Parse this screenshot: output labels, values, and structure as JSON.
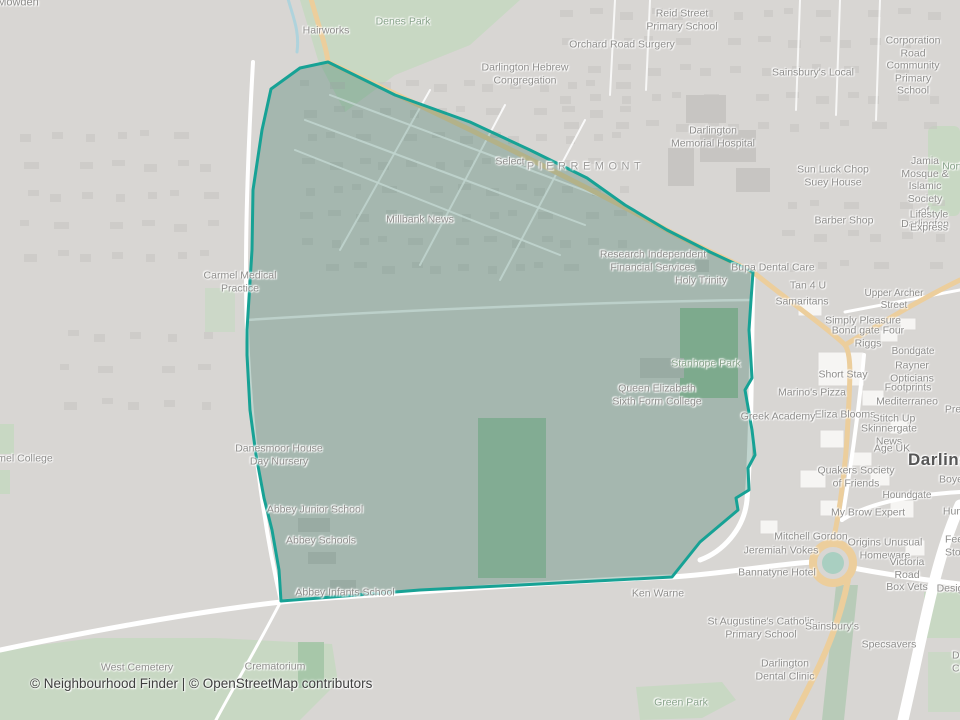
{
  "attribution": "© Neighbourhood Finder | © OpenStreetMap contributors",
  "colors": {
    "base": "#d8d6d3",
    "road_white": "#ffffff",
    "road_primary": "#ecce9c",
    "green_area": "#c8d8c3",
    "green_area_dark": "#9fc3a3",
    "water": "#abd3dd",
    "building": "#c7c5c2",
    "building_white": "#f6f5f3",
    "boundary": "#17a295",
    "boundary_fill": "rgba(47,112,92,0.30)",
    "label_gray": "#8e8d8b",
    "label_green": "#87a289",
    "label_dark": "#565656",
    "attribution_text": "#3f3f3f"
  },
  "map_labels": [
    {
      "text": "Mowden",
      "x": 18,
      "y": 3,
      "type": "place"
    },
    {
      "text": "Hairworks",
      "x": 326,
      "y": 31,
      "type": "poi"
    },
    {
      "text": "Denes Park",
      "x": 403,
      "y": 22,
      "type": "park"
    },
    {
      "text": "Reid Street\nPrimary School",
      "x": 682,
      "y": 20,
      "type": "poi"
    },
    {
      "text": "Orchard Road Surgery",
      "x": 622,
      "y": 45,
      "type": "poi"
    },
    {
      "text": "Darlington Hebrew\nCongregation",
      "x": 525,
      "y": 74,
      "type": "poi"
    },
    {
      "text": "Sainsbury's Local",
      "x": 813,
      "y": 73,
      "type": "poi"
    },
    {
      "text": "Corporation\nRoad Community\nPrimary School",
      "x": 913,
      "y": 66,
      "type": "poi"
    },
    {
      "text": "Darlington\nMemorial Hospital",
      "x": 713,
      "y": 137,
      "type": "poi"
    },
    {
      "text": "Select",
      "x": 510,
      "y": 162,
      "type": "poi"
    },
    {
      "text": "PIERREMONT",
      "x": 586,
      "y": 167,
      "type": "district"
    },
    {
      "text": "Sun Luck Chop\nSuey House",
      "x": 833,
      "y": 176,
      "type": "poi"
    },
    {
      "text": "Nort",
      "x": 952,
      "y": 167,
      "type": "park"
    },
    {
      "text": "Jamia Mosque &\nIslamic Society\nof Darlington",
      "x": 925,
      "y": 193,
      "type": "poi"
    },
    {
      "text": "Millbank News",
      "x": 420,
      "y": 220,
      "type": "poi"
    },
    {
      "text": "Barber Shop",
      "x": 844,
      "y": 221,
      "type": "poi"
    },
    {
      "text": "Lifestyle Express",
      "x": 929,
      "y": 221,
      "type": "poi"
    },
    {
      "text": "Research Independent\nFinancial Services",
      "x": 653,
      "y": 261,
      "type": "poi"
    },
    {
      "text": "Bupa Dental Care",
      "x": 773,
      "y": 268,
      "type": "poi"
    },
    {
      "text": "Holy Trinity",
      "x": 701,
      "y": 281,
      "type": "poi"
    },
    {
      "text": "Carmel Medical\nPractice",
      "x": 240,
      "y": 282,
      "type": "poi"
    },
    {
      "text": "Tan 4 U",
      "x": 808,
      "y": 286,
      "type": "poi"
    },
    {
      "text": "Samaritans",
      "x": 802,
      "y": 302,
      "type": "poi"
    },
    {
      "text": "Upper Archer Street",
      "x": 894,
      "y": 300,
      "type": "street"
    },
    {
      "text": "Simply Pleasure",
      "x": 863,
      "y": 321,
      "type": "poi"
    },
    {
      "text": "Bond gate Four Riggs",
      "x": 868,
      "y": 337,
      "type": "poi"
    },
    {
      "text": "Bondgate",
      "x": 913,
      "y": 352,
      "type": "street"
    },
    {
      "text": "Stanhope Park",
      "x": 706,
      "y": 364,
      "type": "park"
    },
    {
      "text": "Short Stay",
      "x": 843,
      "y": 375,
      "type": "poi"
    },
    {
      "text": "Rayner Opticians",
      "x": 912,
      "y": 372,
      "type": "poi"
    },
    {
      "text": "Footprints",
      "x": 908,
      "y": 388,
      "type": "poi"
    },
    {
      "text": "Marino's Pizza",
      "x": 812,
      "y": 393,
      "type": "poi"
    },
    {
      "text": "Queen Elizabeth\nSixth Form College",
      "x": 657,
      "y": 395,
      "type": "poi"
    },
    {
      "text": "Mediterraneo",
      "x": 907,
      "y": 402,
      "type": "poi"
    },
    {
      "text": "Pre",
      "x": 953,
      "y": 410,
      "type": "poi"
    },
    {
      "text": "Eliza Blooms",
      "x": 845,
      "y": 415,
      "type": "poi"
    },
    {
      "text": "Greek Academy",
      "x": 778,
      "y": 417,
      "type": "poi"
    },
    {
      "text": "Stitch Up",
      "x": 894,
      "y": 419,
      "type": "poi"
    },
    {
      "text": "Skinnergate News",
      "x": 889,
      "y": 435,
      "type": "poi"
    },
    {
      "text": "Age UK",
      "x": 892,
      "y": 449,
      "type": "poi"
    },
    {
      "text": "Danesmoor House\nDay Nursery",
      "x": 279,
      "y": 455,
      "type": "poi"
    },
    {
      "text": "mel College",
      "x": 25,
      "y": 459,
      "type": "poi"
    },
    {
      "text": "Darlington",
      "x": 908,
      "y": 460,
      "type": "town",
      "anchor": "left"
    },
    {
      "text": "Quakers Society\nof Friends",
      "x": 856,
      "y": 477,
      "type": "poi"
    },
    {
      "text": "Boye",
      "x": 951,
      "y": 480,
      "type": "poi"
    },
    {
      "text": "Houndgate",
      "x": 907,
      "y": 496,
      "type": "street"
    },
    {
      "text": "Abbey Junior School",
      "x": 315,
      "y": 510,
      "type": "poi"
    },
    {
      "text": "My Brow Expert",
      "x": 868,
      "y": 513,
      "type": "poi"
    },
    {
      "text": "Hum",
      "x": 954,
      "y": 512,
      "type": "poi"
    },
    {
      "text": "Mitchell Gordon",
      "x": 811,
      "y": 537,
      "type": "poi"
    },
    {
      "text": "Abbey Schools",
      "x": 321,
      "y": 541,
      "type": "poi"
    },
    {
      "text": "Origins Unusual\nHomeware",
      "x": 885,
      "y": 549,
      "type": "poi"
    },
    {
      "text": "Feetha\nStorey",
      "x": 945,
      "y": 546,
      "type": "poi",
      "anchor": "left"
    },
    {
      "text": "Jeremiah Vokes",
      "x": 781,
      "y": 551,
      "type": "poi"
    },
    {
      "text": "Bannatyne Hotel",
      "x": 777,
      "y": 573,
      "type": "poi"
    },
    {
      "text": "Victoria Road\nBox Vets",
      "x": 907,
      "y": 575,
      "type": "poi"
    },
    {
      "text": "Desig",
      "x": 950,
      "y": 589,
      "type": "poi"
    },
    {
      "text": "Abbey Infants School",
      "x": 345,
      "y": 593,
      "type": "poi"
    },
    {
      "text": "Ken Warne",
      "x": 658,
      "y": 594,
      "type": "poi"
    },
    {
      "text": "St Augustine's Catholic\nPrimary School",
      "x": 761,
      "y": 628,
      "type": "poi"
    },
    {
      "text": "Sainsbury's",
      "x": 832,
      "y": 627,
      "type": "poi"
    },
    {
      "text": "Specsavers",
      "x": 889,
      "y": 645,
      "type": "poi"
    },
    {
      "text": "Da\nCri",
      "x": 952,
      "y": 662,
      "type": "poi",
      "anchor": "left"
    },
    {
      "text": "West Cemetery",
      "x": 137,
      "y": 668,
      "type": "poi"
    },
    {
      "text": "Crematorium",
      "x": 275,
      "y": 667,
      "type": "poi"
    },
    {
      "text": "Darlington\nDental Clinic",
      "x": 785,
      "y": 670,
      "type": "poi"
    },
    {
      "text": "Green Park",
      "x": 681,
      "y": 703,
      "type": "park"
    }
  ]
}
